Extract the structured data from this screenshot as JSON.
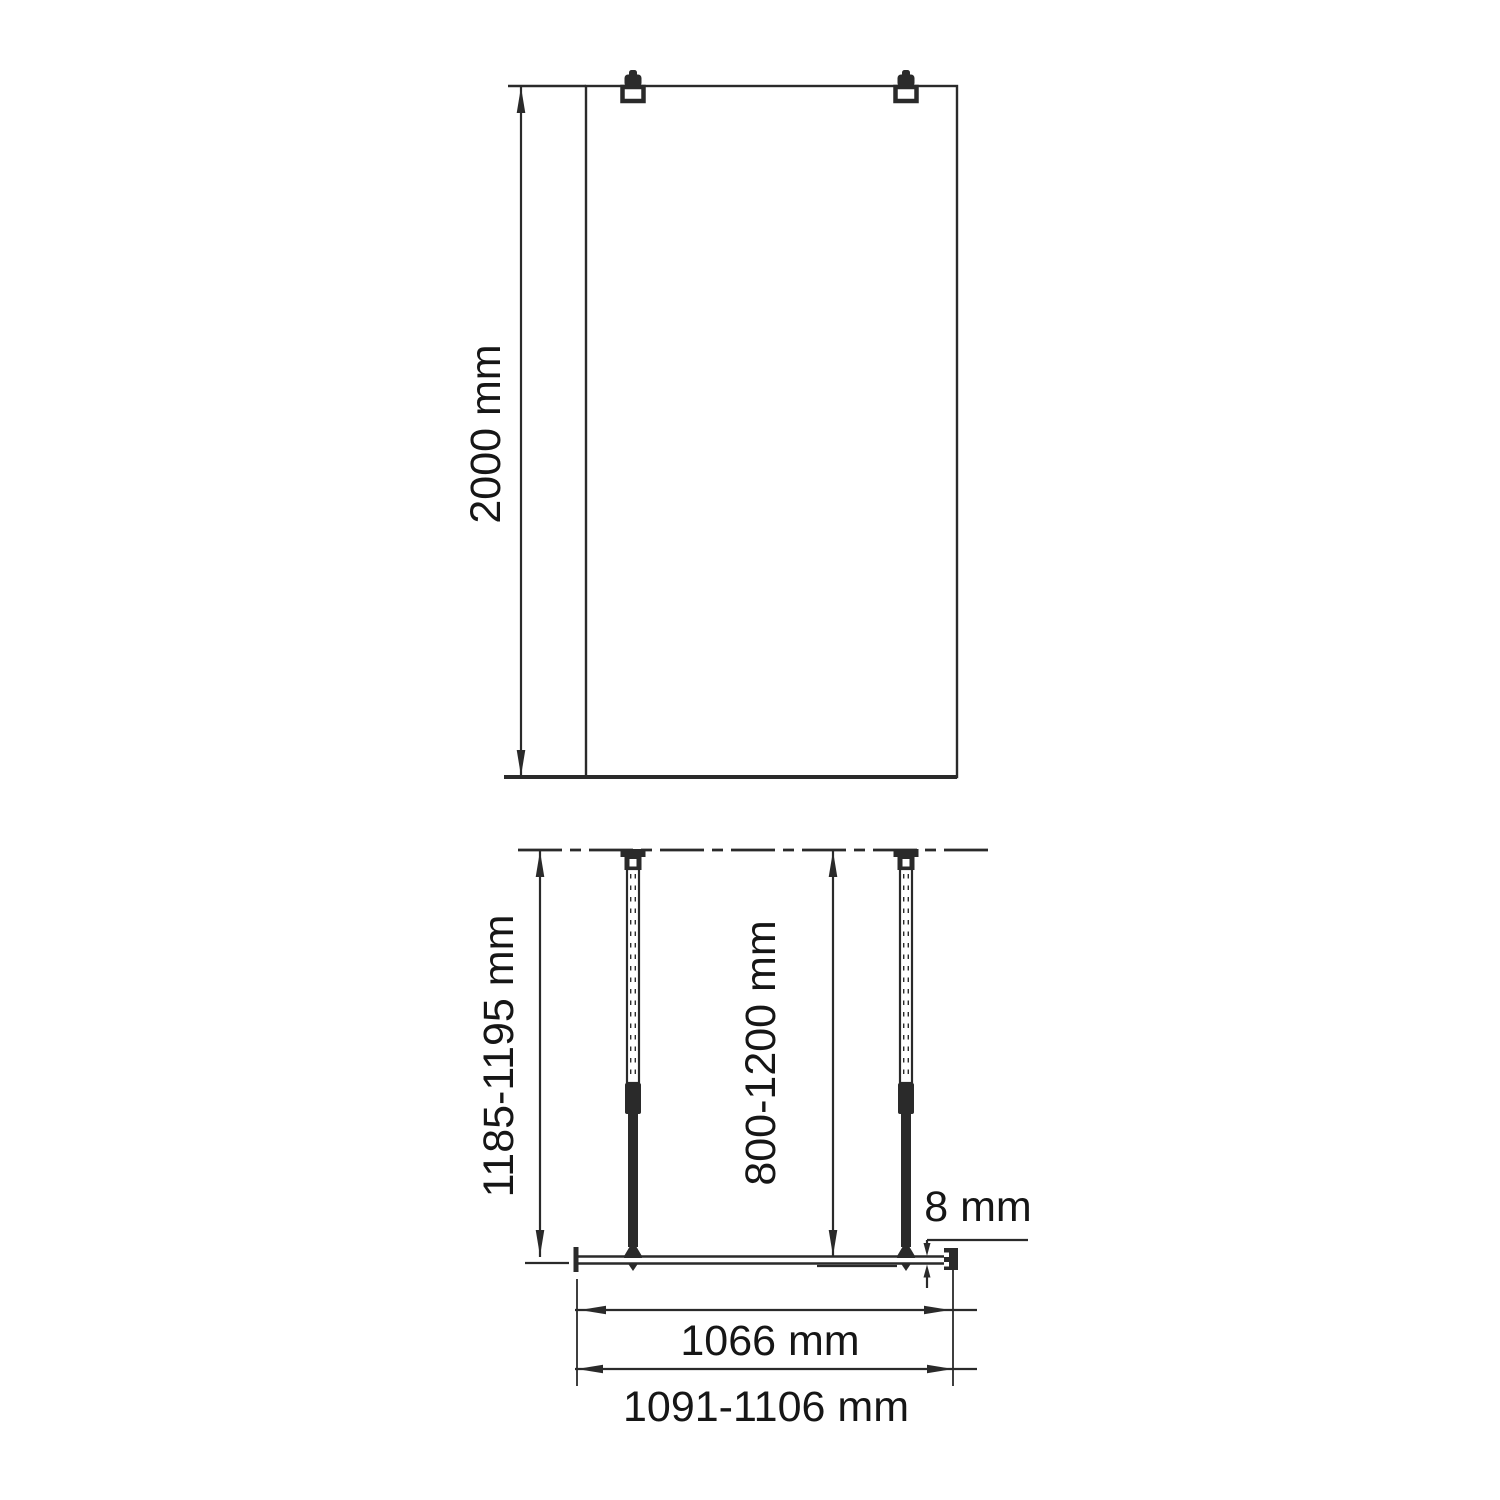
{
  "labels": {
    "front_height": "2000 mm",
    "plan_total_depth": "1185-1195 mm",
    "plan_bar_length": "800-1200 mm",
    "glass_thickness": "8 mm",
    "glass_width": "1066 mm",
    "total_width": "1091-1106 mm"
  },
  "colors": {
    "line": "#2a2a2a",
    "text": "#161616",
    "background": "#ffffff"
  }
}
